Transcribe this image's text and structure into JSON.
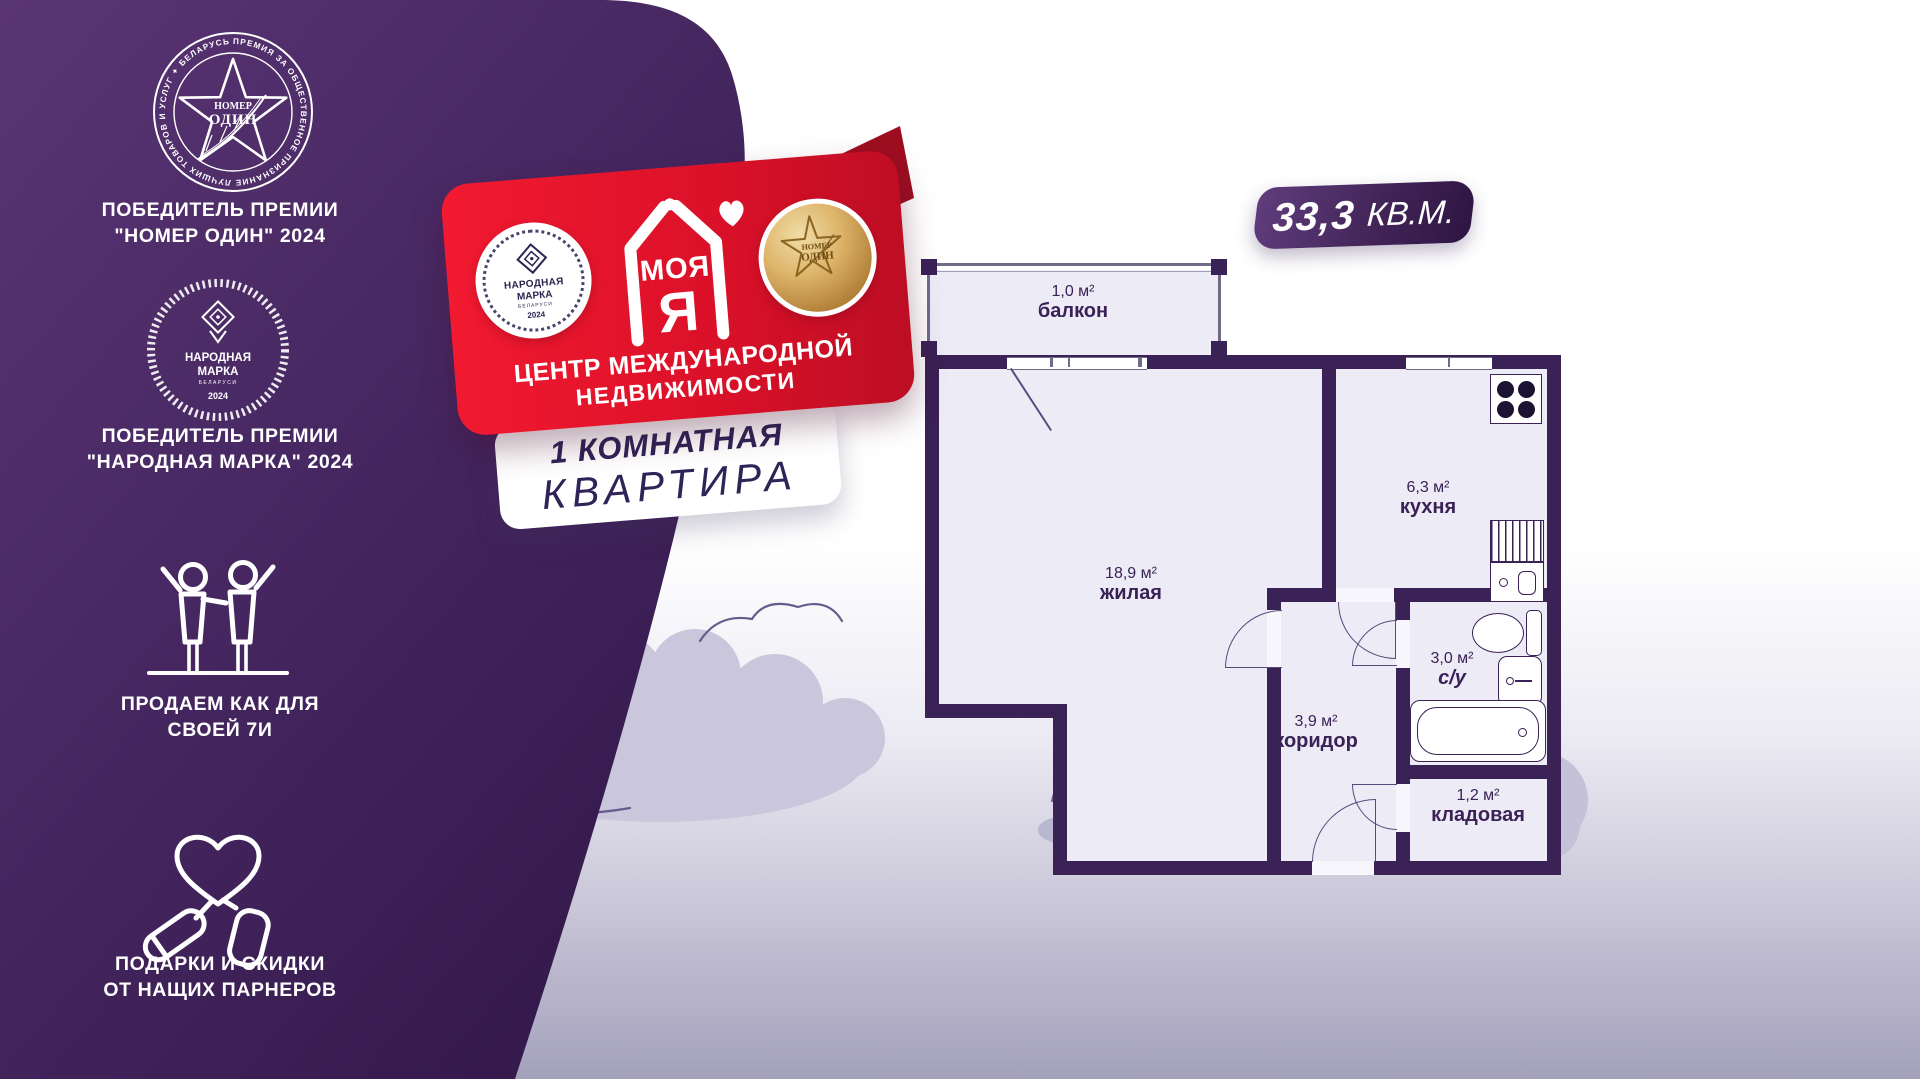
{
  "sidebar": {
    "award_one": {
      "medal_line1": "НОМЕР",
      "medal_line2": "ОДИН",
      "ring_text": "ПРЕМИЯ ЗА ОБЩЕСТВЕННОЕ ПРИЗНАНИЕ ЛУЧШИХ ТОВАРОВ И УСЛУГ ✦ БЕЛАРУСЬ 2024 ✦",
      "caption_line1": "ПОБЕДИТЕЛЬ ПРЕМИИ",
      "caption_line2": "\"НОМЕР ОДИН\" 2024"
    },
    "award_two": {
      "badge_line1": "НАРОДНАЯ",
      "badge_line2": "МАРКА",
      "badge_country": "БЕЛАРУСИ",
      "badge_year": "2024",
      "caption_line1": "ПОБЕДИТЕЛЬ ПРЕМИИ",
      "caption_line2": "\"НАРОДНАЯ МАРКА\" 2024"
    },
    "family": {
      "caption_line1": "ПРОДАЕМ КАК ДЛЯ",
      "caption_line2": "СВОЕЙ 7И"
    },
    "gifts": {
      "caption_line1": "ПОДАРКИ И СКИДКИ",
      "caption_line2": "ОТ НАЩИХ ПАРНЕРОВ"
    }
  },
  "ribbon": {
    "left_badge": {
      "line1": "НАРОДНАЯ",
      "line2": "МАРКА",
      "country": "БЕЛАРУСИ",
      "year": "2024"
    },
    "logo_word": "МОЯ",
    "logo_letter": "Я",
    "right_medal": {
      "line1": "НОМЕР",
      "line2": "ОДИН"
    },
    "subtitle_line1": "ЦЕНТР МЕЖДУНАРОДНОЙ",
    "subtitle_line2": "НЕДВИЖИМОСТИ"
  },
  "apartment_banner": {
    "line1": "1 КОМНАТНАЯ",
    "line2": "КВАРТИРА"
  },
  "floorplan": {
    "total_area_value": "33,3",
    "total_area_unit": "КВ.М.",
    "rooms": [
      {
        "id": "balcony",
        "area": "1,0 м²",
        "name": "балкон"
      },
      {
        "id": "living",
        "area": "18,9 м²",
        "name": "жилая"
      },
      {
        "id": "kitchen",
        "area": "6,3 м²",
        "name": "кухня"
      },
      {
        "id": "bathroom",
        "area": "3,0 м²",
        "name": "с/у"
      },
      {
        "id": "corridor",
        "area": "3,9 м²",
        "name": "коридор"
      },
      {
        "id": "storage",
        "area": "1,2 м²",
        "name": "кладовая"
      }
    ]
  },
  "colors": {
    "purple_dark": "#371b4e",
    "purple_mid": "#5a3574",
    "ribbon_red": "#dc1129",
    "ribbon_red_dark": "#9e0e20",
    "wall": "#3a2156",
    "floor": "#edecf6",
    "gold": "#c79a4b",
    "banner_text": "#2f2358",
    "cloud": "#c4c1d8"
  }
}
